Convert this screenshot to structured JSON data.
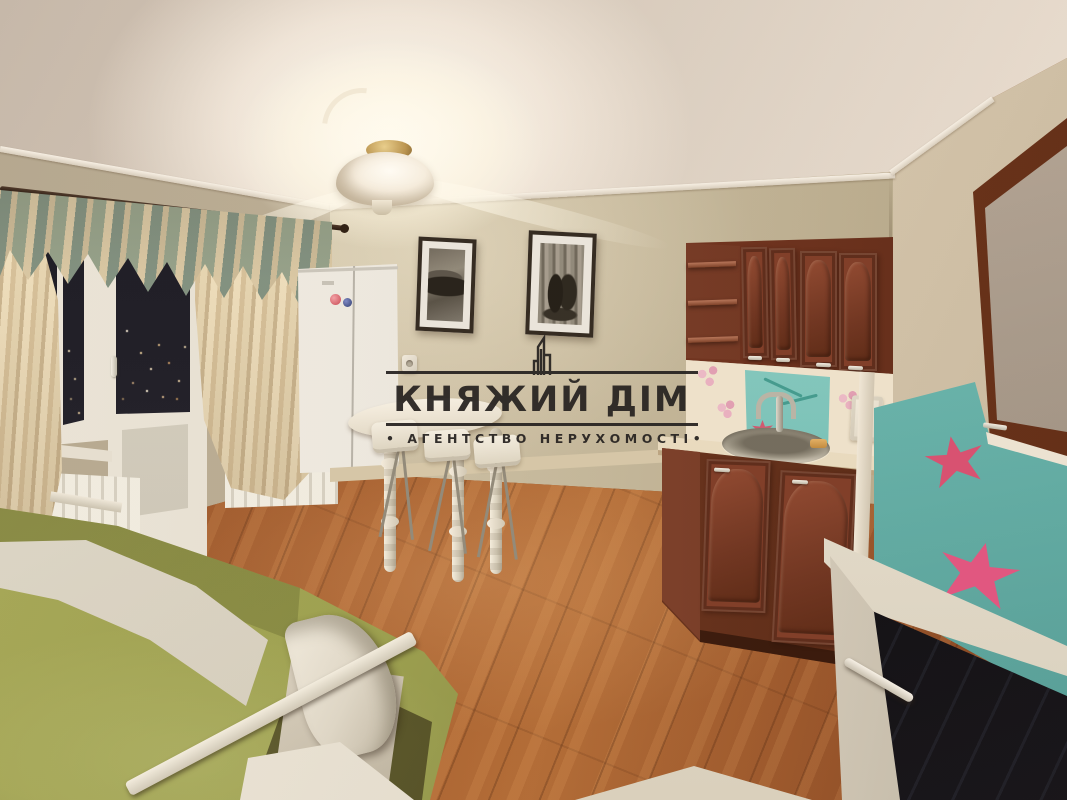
{
  "meta": {
    "domain": "natural-image",
    "description": "Night-time interior photo of a studio apartment: olive-green sofa, white dining table with stools, white refrigerator, balcony window with cream curtains, dark cherry kitchen with teal floral glass backsplash, red-brown laminate floor, lit ceiling lamp. Real-estate agency watermark centered.",
    "width_px": 1067,
    "height_px": 800
  },
  "watermark": {
    "title": "КНЯЖИЙ ДІМ",
    "subtitle": "АГЕНТСТВО НЕРУХОМОСТІ",
    "bullet": "•",
    "logo_icon": "city-skyline-icon",
    "color": "#262220"
  },
  "scene": {
    "room": "studio apartment living room with kitchen corner",
    "lighting": "single glowing ceiling lamp; night city lights visible through window",
    "objects": [
      {
        "name": "ceiling-lamp",
        "desc": "glowing white glass ceiling light with gold mount"
      },
      {
        "name": "balcony-window",
        "desc": "white window and balcony door, dark night glass with distant city lights"
      },
      {
        "name": "curtains",
        "desc": "cream curtains with green-and-tan patterned valance on a dark rod"
      },
      {
        "name": "radiator",
        "desc": "white panel radiators below the window"
      },
      {
        "name": "refrigerator",
        "desc": "white two-door fridge with pink and blue magnets"
      },
      {
        "name": "wall-art",
        "desc": "two framed black-and-white prints with white mats"
      },
      {
        "name": "kitchen-cabinets",
        "desc": "dark cherry upper and base cabinets with open corner shelves and white handles"
      },
      {
        "name": "backsplash",
        "desc": "cream and teal glass backsplash with pink flowers, red maple leaves and dragonflies"
      },
      {
        "name": "sink",
        "desc": "round stainless sink with chrome mixer tap and amber sponge"
      },
      {
        "name": "glass-cabinet",
        "desc": "frosted-glass wall cabinet on right wall"
      },
      {
        "name": "stove",
        "desc": "white cooker with black glass cooktop and white oven handle"
      },
      {
        "name": "dining-table",
        "desc": "white table with turned legs and three white stools on metal legs"
      },
      {
        "name": "sofa",
        "desc": "olive-green sofa bed with floral throw, white wooden rail and curved armrest"
      },
      {
        "name": "floor",
        "desc": "red-brown oak laminate planks"
      }
    ],
    "colors": {
      "wall_beige": "#c7bda6",
      "ceiling": "#e2d9d0",
      "floor_wood": "#9a5a30",
      "cabinet_wood": "#7a3a26",
      "sofa_green": "#9ea352",
      "curtain_cream": "#ead9b8",
      "valance_green": "#93a18c",
      "backsplash_teal": "#74c1ba",
      "accent_pink": "#d84a6a",
      "window_night": "#16161e",
      "counter_cream": "#eadfca",
      "white_goods": "#e9e6df",
      "watermark_ink": "#262220"
    }
  }
}
